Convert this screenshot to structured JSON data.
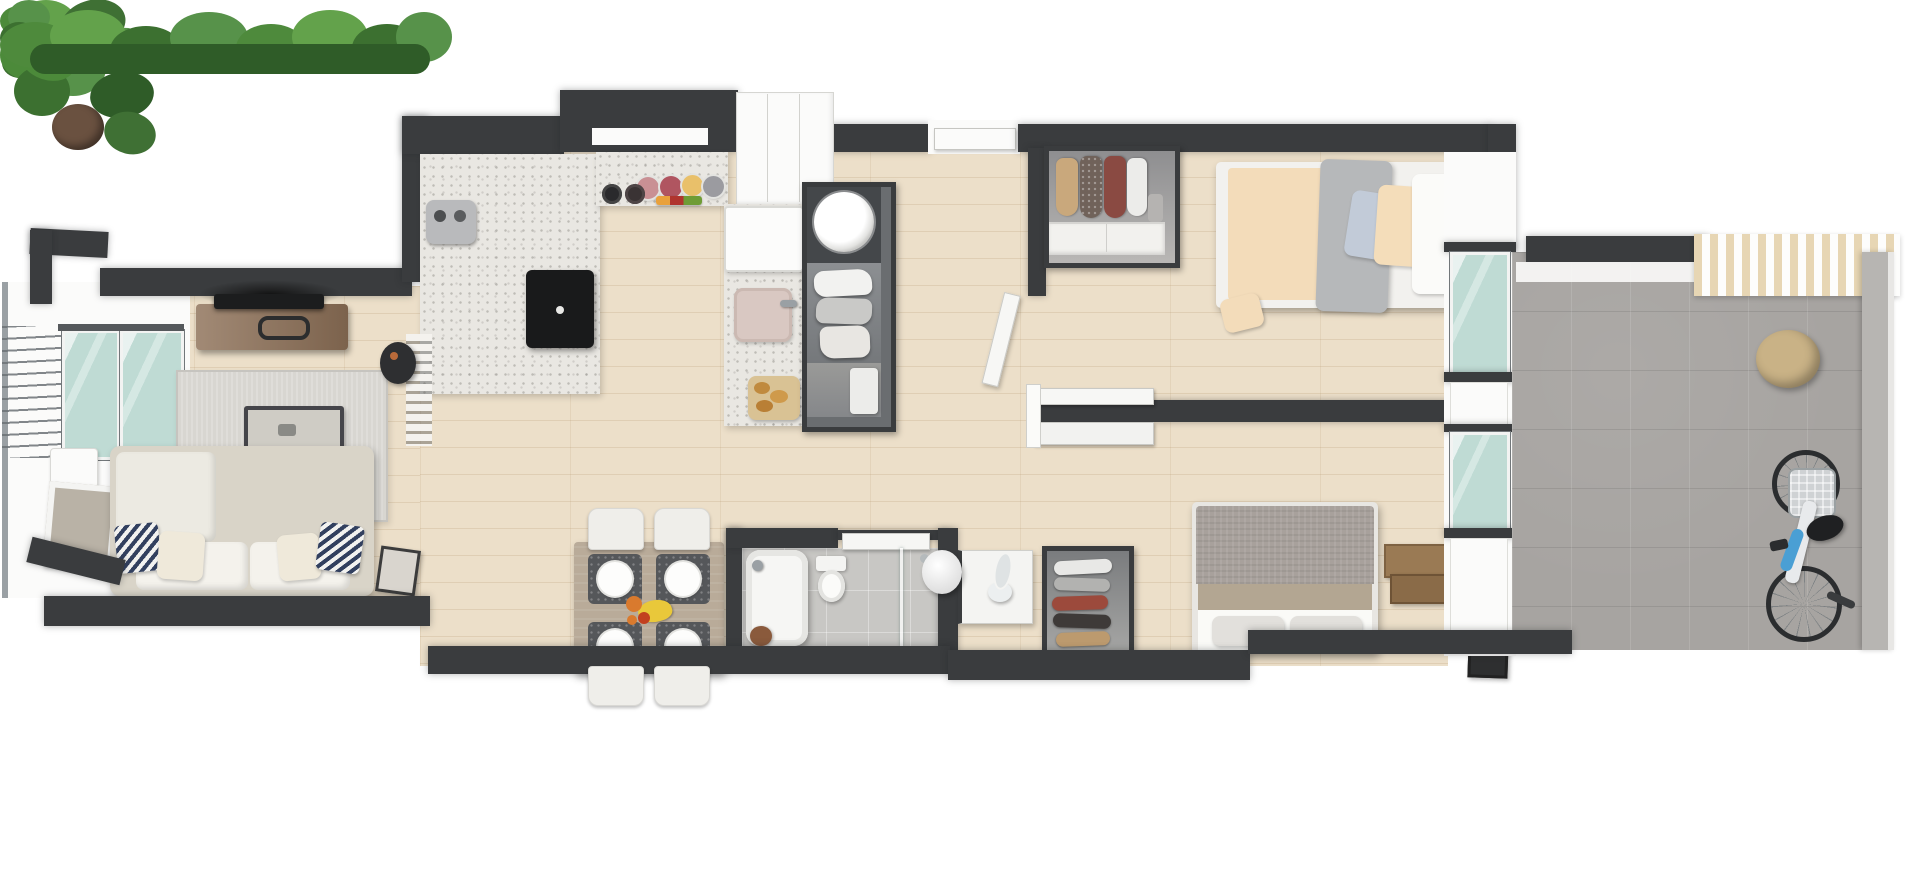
{
  "scene": {
    "kind": "3d-apartment-floor-plan-top-view",
    "rooms": [
      {
        "id": "balcony",
        "label_items": [
          "railing",
          "glass-door",
          "plant",
          "picture-frame",
          "side-table"
        ]
      },
      {
        "id": "living-room",
        "label_items": [
          "sofa",
          "zigzag-pillows",
          "rug",
          "coffee-table",
          "tv",
          "tv-console",
          "potted-plants",
          "books",
          "slat-divider",
          "wine-stool"
        ]
      },
      {
        "id": "kitchen",
        "label_items": [
          "terrazzo-counter",
          "induction-cooktop",
          "espresso-machine",
          "serving-plates",
          "bowls",
          "fridge",
          "sink",
          "bread-board"
        ]
      },
      {
        "id": "laundry-closet",
        "label_items": [
          "washing-machine",
          "hanging-clothes"
        ]
      },
      {
        "id": "dining-area",
        "label_items": [
          "table",
          "four-chairs",
          "four-plates",
          "placemats",
          "fruit-bowl"
        ]
      },
      {
        "id": "bathroom",
        "label_items": [
          "bathtub",
          "faucet",
          "toilet",
          "shower-glass",
          "stool",
          "sliding-door"
        ]
      },
      {
        "id": "hallway",
        "label_items": [
          "entry-cabinet",
          "front-door",
          "jug-lamp",
          "standing-mirror"
        ]
      },
      {
        "id": "bedroom-2",
        "label_items": [
          "single-bed",
          "open-wardrobe",
          "hanging-garments",
          "pillows",
          "gray-blanket"
        ]
      },
      {
        "id": "master-bedroom",
        "label_items": [
          "double-bed",
          "gray-headboard",
          "pillows",
          "shoe-wardrobe",
          "door-leaf",
          "wood-crates",
          "picture-frames",
          "sliding-partition"
        ]
      },
      {
        "id": "terrace",
        "label_items": [
          "concrete-tiles",
          "pergola",
          "potted-plant",
          "bicycle",
          "greenery"
        ]
      }
    ]
  },
  "palette": {
    "wall": "#3a3c3e",
    "wood": "#ecdfc9",
    "terrazzo": "#e9e7e2",
    "tile_bath": "#c8c7c4",
    "tile_terrace": "#a7a4a1",
    "glass": "#bfdbd4",
    "rug": "#d8d6d1",
    "sofa": "#d9d4c8",
    "cushion": "#f4f2ec",
    "navy": "#32405f",
    "console_wood": "#8d7057",
    "table_tan": "#b9ab99",
    "placemat": "#55575a",
    "bed_cream": "#f3dcba",
    "blanket_gray": "#b6b8ba",
    "headboard": "#a8a19c",
    "duvet_white": "#fafaf7",
    "plant": "#57924a",
    "plant_dark": "#3c7030",
    "pot": "#c9b286",
    "pergola": "#e7d6b4",
    "bike_blue": "#4a9fd4",
    "plate_pink": "#c99094",
    "plate_red": "#b05560",
    "plate_yellow": "#e9c06a",
    "plate_gray": "#9b9ba0"
  }
}
